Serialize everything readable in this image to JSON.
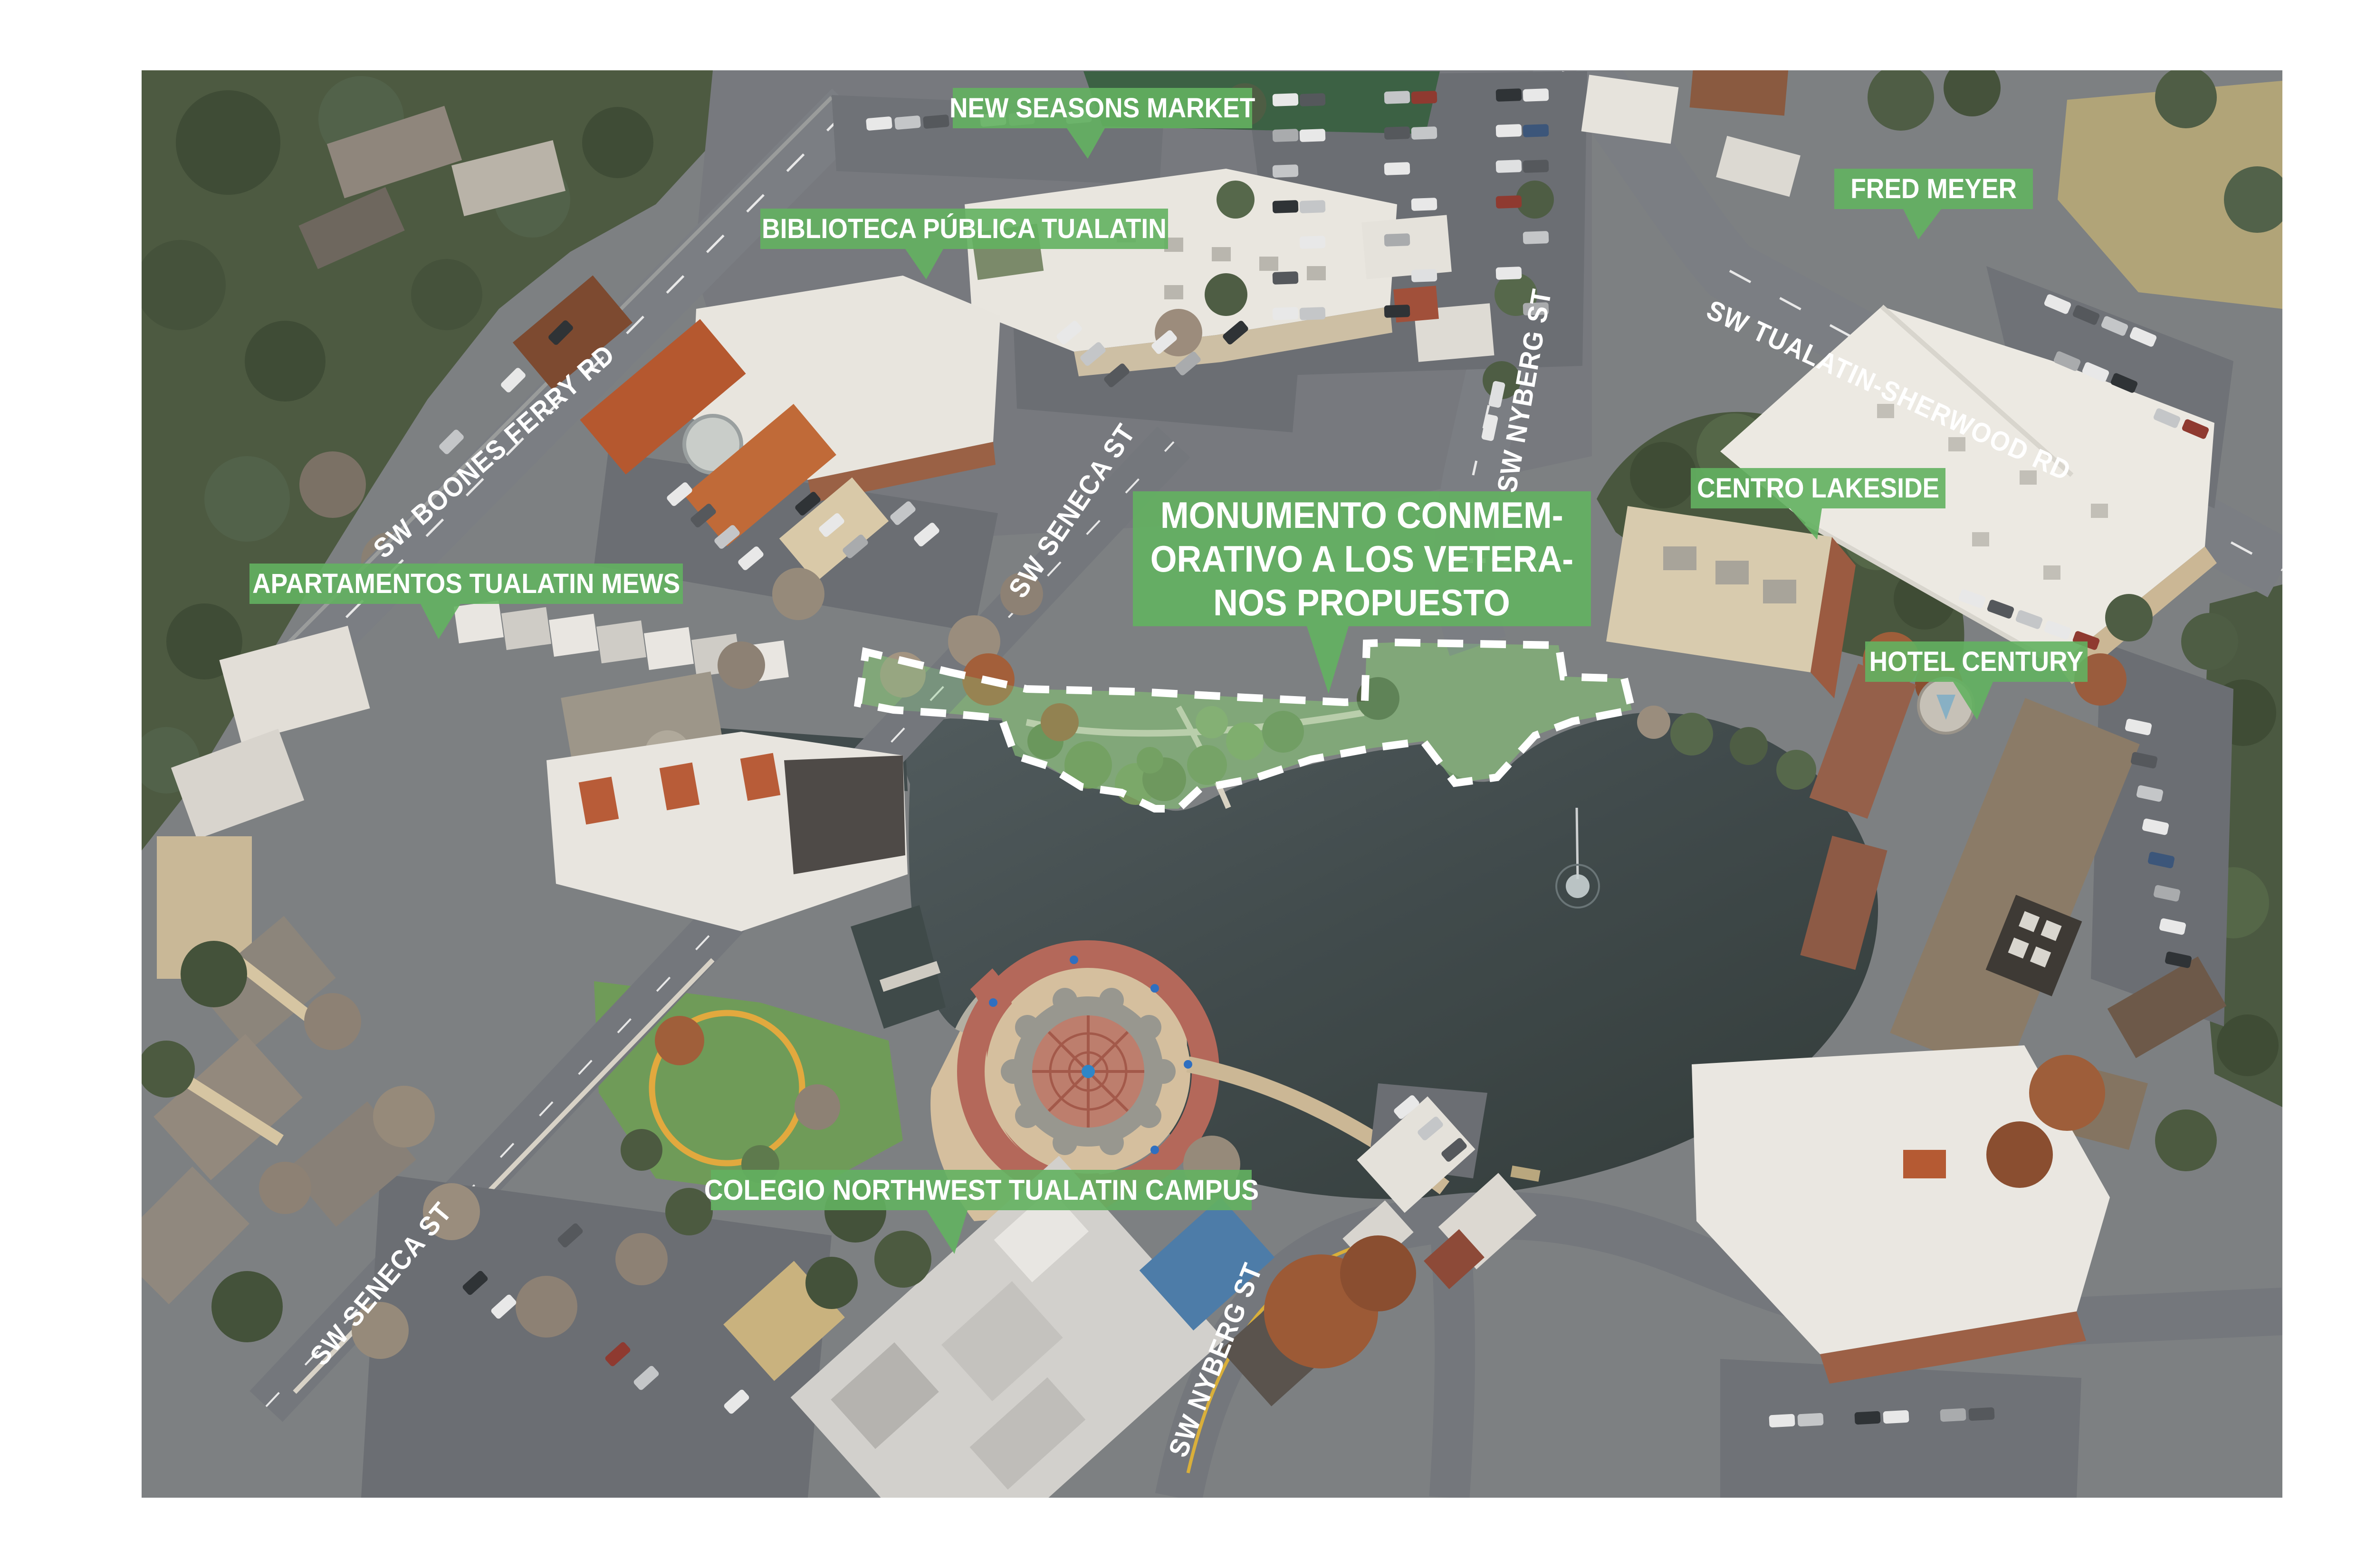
{
  "annotations": {
    "place_labels": [
      {
        "id": "new-seasons",
        "text": "NEW SEASONS MARKET"
      },
      {
        "id": "library",
        "text": "BIBLIOTECA PÚBLICA TUALATIN"
      },
      {
        "id": "fred-meyer",
        "text": "FRED MEYER"
      },
      {
        "id": "centro-lakeside",
        "text": "CENTRO LAKESIDE"
      },
      {
        "id": "hotel-century",
        "text": "HOTEL CENTURY"
      },
      {
        "id": "apartamentos",
        "text": "APARTAMENTOS TUALATIN MEWS"
      },
      {
        "id": "colegio",
        "text": "COLEGIO NORTHWEST TUALATIN CAMPUS"
      }
    ],
    "proposed_site_label": {
      "line1": "MONUMENTO CONMEM-",
      "line2": "ORATIVO A LOS VETERA-",
      "line3": "NOS PROPUESTO"
    },
    "street_labels": [
      {
        "id": "boones-ferry",
        "text": "SW BOONES FERRY RD"
      },
      {
        "id": "nyberg-top",
        "text": "SW NYBERG ST"
      },
      {
        "id": "tualatin-sherwood",
        "text": "SW TUALATIN-SHERWOOD RD"
      },
      {
        "id": "seneca-mid",
        "text": "SW SENECA ST"
      },
      {
        "id": "seneca-bottom",
        "text": "SW SENECA ST"
      },
      {
        "id": "nyberg-bottom",
        "text": "SW NYBERG ST"
      }
    ],
    "colors": {
      "label_green": "#63b161",
      "outline_white": "#ffffff",
      "site_fill": "rgba(130,200,130,0.35)"
    }
  }
}
